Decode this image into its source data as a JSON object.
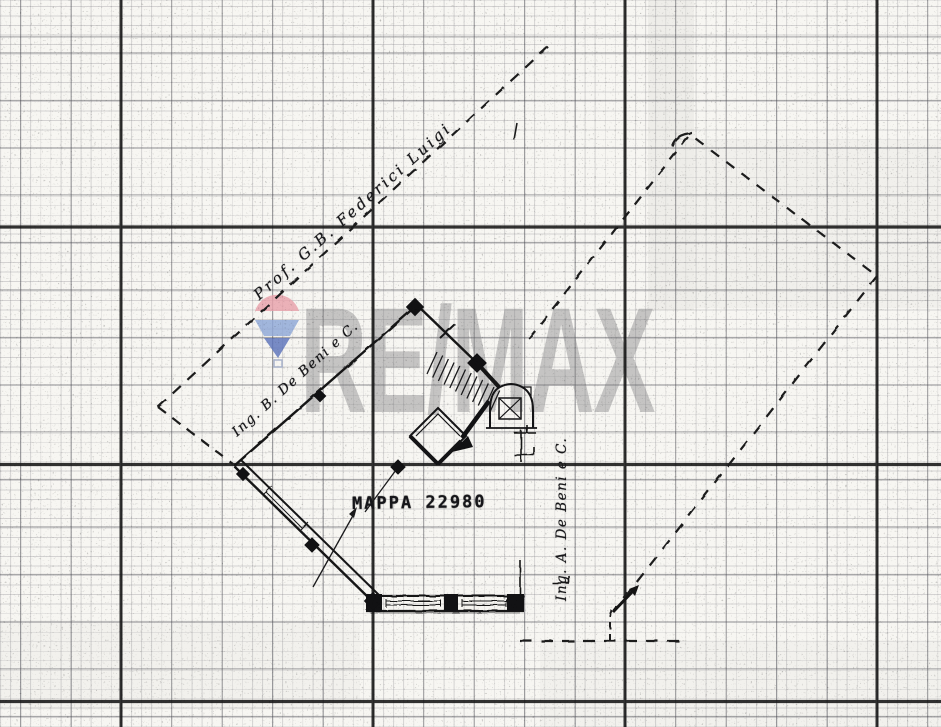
{
  "document": {
    "kind_label": "Scanned cadastral site plan on graph paper",
    "paper_color": "#f7f6f2",
    "ink_color": "#17171a"
  },
  "watermark": {
    "brand_text": "RE/MAX",
    "balloon_icon": "remax-balloon-icon",
    "text_color": "#7a7a7c",
    "balloon_top_color": "#e9a2ac",
    "balloon_band_color": "#8fa8d8",
    "balloon_tip_color": "#5d74bc"
  },
  "annotations": {
    "neighbor_top": "Prof. G.B. Federici Luigi",
    "owner_upper_wall": "Ing. B. De Beni e C.",
    "owner_right_side": "Ing. A. De Beni e C.",
    "map_stamp": "MAPPA 22980"
  },
  "grid": {
    "heavy_vertical_x": "121, 373, 625, 877",
    "heavy_horizontal_y": "227, 464, 701"
  }
}
